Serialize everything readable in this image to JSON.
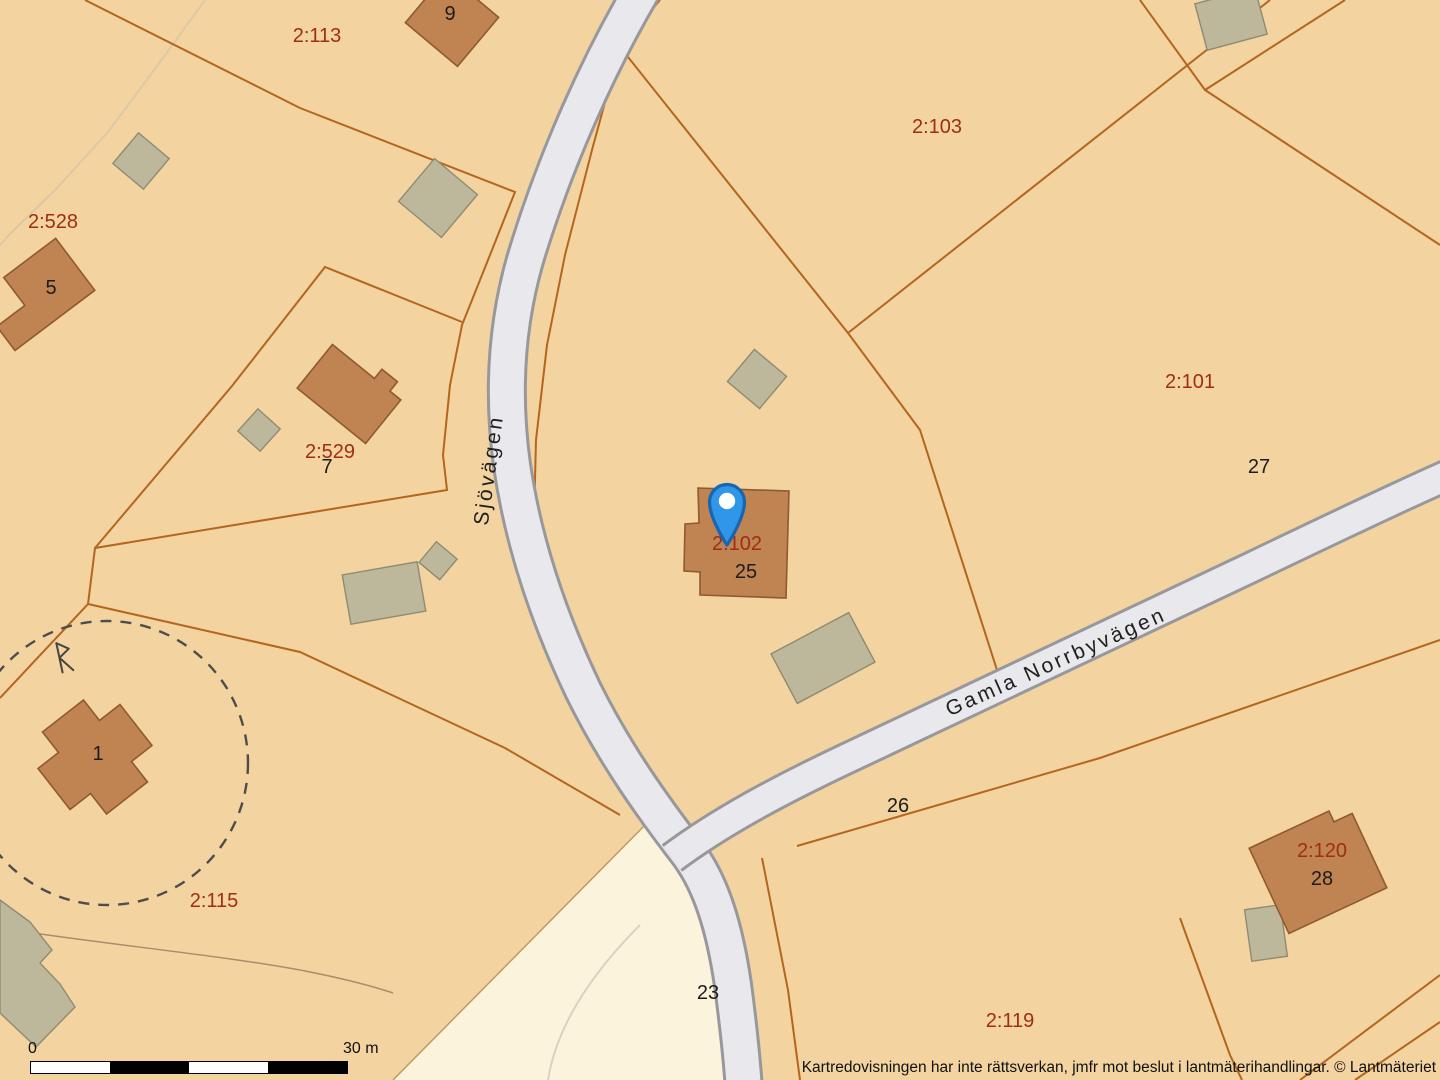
{
  "map": {
    "colors": {
      "land": "#f3d3a0",
      "field": "#fcf3dc",
      "road_fill": "#e9e9ed",
      "road_edge": "#98989c",
      "boundary": "#b5651d",
      "building_fill": "#c08352",
      "building_stroke": "#8f5a2e",
      "outbuilding_fill": "#bdb89c",
      "outbuilding_stroke": "#8f8b72",
      "parcel_label": "#a02e15",
      "house_number": "#1c1c1c",
      "pin_fill": "#2f96e8",
      "pin_stroke": "#1866b2"
    },
    "parcel_labels": [
      {
        "text": "2:113",
        "x": 317,
        "y": 36
      },
      {
        "text": "2:528",
        "x": 53,
        "y": 222
      },
      {
        "text": "2:529",
        "x": 330,
        "y": 452
      },
      {
        "text": "2:103",
        "x": 937,
        "y": 127
      },
      {
        "text": "2:101",
        "x": 1190,
        "y": 382
      },
      {
        "text": "2:102",
        "x": 737,
        "y": 544
      },
      {
        "text": "2:115",
        "x": 214,
        "y": 901
      },
      {
        "text": "2:119",
        "x": 1010,
        "y": 1021
      },
      {
        "text": "2:120",
        "x": 1322,
        "y": 851
      }
    ],
    "house_numbers": [
      {
        "text": "9",
        "x": 450,
        "y": 14
      },
      {
        "text": "5",
        "x": 51,
        "y": 288
      },
      {
        "text": "7",
        "x": 327,
        "y": 467
      },
      {
        "text": "25",
        "x": 746,
        "y": 572
      },
      {
        "text": "27",
        "x": 1259,
        "y": 467
      },
      {
        "text": "1",
        "x": 98,
        "y": 754
      },
      {
        "text": "26",
        "x": 898,
        "y": 806
      },
      {
        "text": "23",
        "x": 708,
        "y": 993
      },
      {
        "text": "28",
        "x": 1322,
        "y": 879
      }
    ],
    "road_labels": [
      {
        "text": "Sjövägen",
        "x": 489,
        "y": 470,
        "rotate": -82
      },
      {
        "text": "Gamla Norrbyvägen",
        "x": 1056,
        "y": 662,
        "rotate": -24
      }
    ],
    "monument_symbol": "rune-R",
    "scale_bar": {
      "start": "0",
      "end": "30 m"
    },
    "attribution": "Kartredovisningen har inte rättsverkan, jmfr mot beslut i lantmäterihandlingar. © Lantmäteriet"
  }
}
